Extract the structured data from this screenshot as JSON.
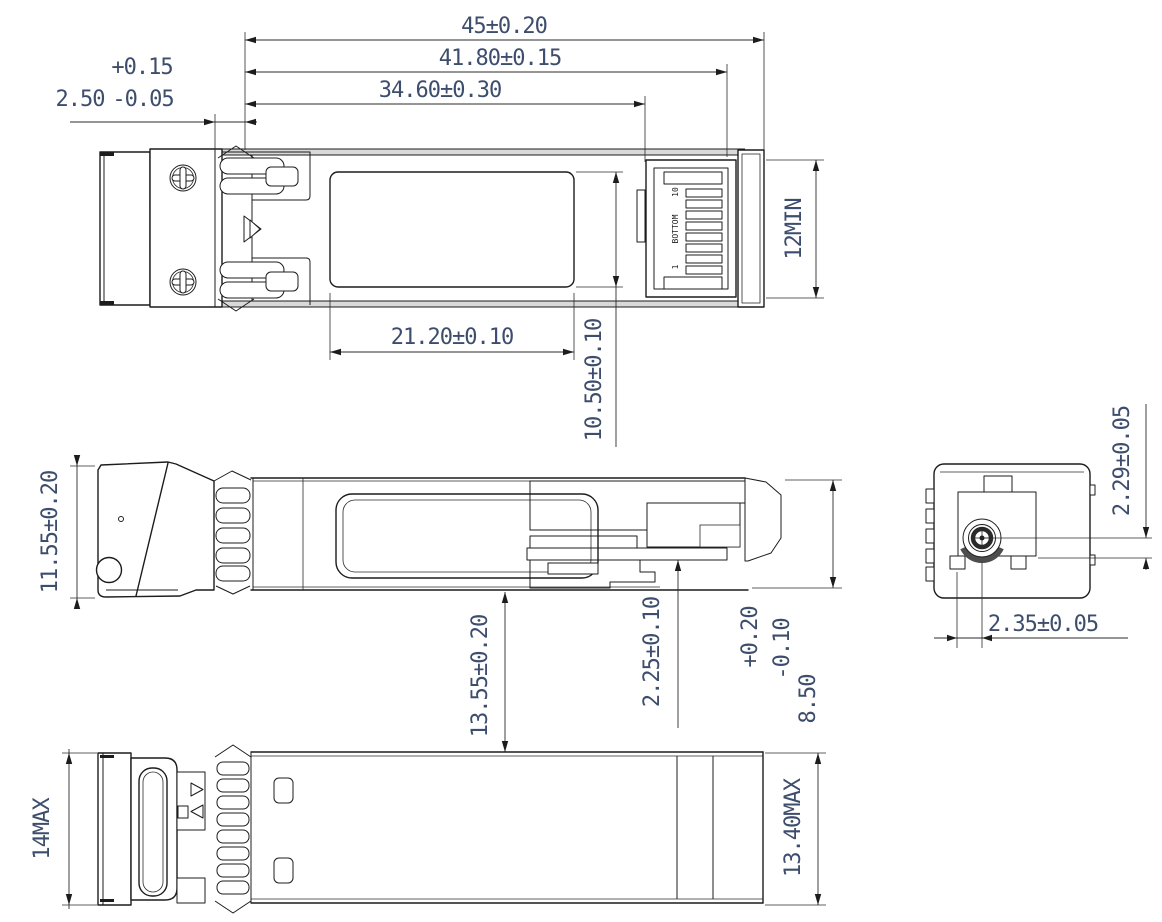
{
  "title": "SFP transceiver module outline drawing",
  "colors": {
    "line": "#1c1c1c",
    "dim_text": "#3d4d6d",
    "background": "#ffffff"
  },
  "views": {
    "top": {
      "dim_overall_length": "45±0.20",
      "dim_body_length": "41.80±0.15",
      "dim_housing_length": "34.60±0.30",
      "dim_latch_value": "2.50",
      "dim_latch_tol_upper": "+0.15",
      "dim_latch_tol_lower": "-0.05",
      "dim_label_length": "21.20±0.10",
      "dim_label_width": "10.50±0.10",
      "dim_port_depth": "12MIN",
      "connector_marking": "BOTTOM",
      "pin_last": "10",
      "pin_first": "1"
    },
    "side": {
      "dim_bail_height": "11.55±0.20",
      "dim_overall_height": "13.55±0.20",
      "dim_pcb_offset": "2.25±0.10",
      "dim_body_height_value": "8.50",
      "dim_body_height_tol_upper": "+0.20",
      "dim_body_height_tol_lower": "-0.10"
    },
    "end": {
      "dim_bore_vertical": "2.29±0.05",
      "dim_bore_horizontal": "2.35±0.05"
    },
    "bottom": {
      "dim_max_height": "14MAX",
      "dim_max_width": "13.40MAX"
    }
  }
}
